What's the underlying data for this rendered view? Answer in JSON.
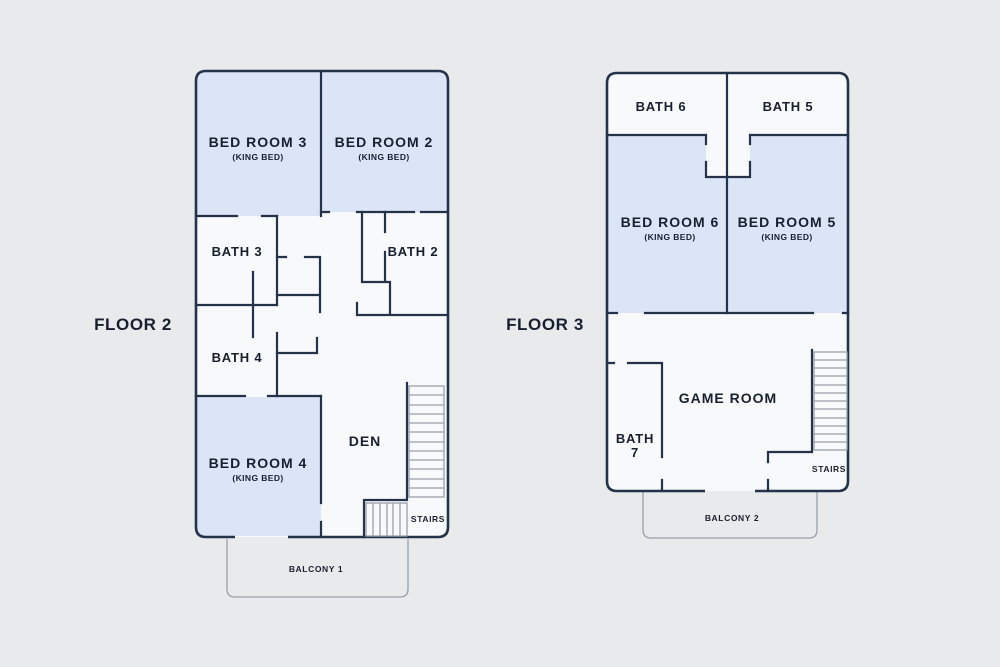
{
  "palette": {
    "background": "#e9eaec",
    "plan_interior": "#f8f9fa",
    "room_fill": "#dbe5f6",
    "wall": "#24324a",
    "stair_balcony_line": "#98a0ab",
    "text": "#18202f"
  },
  "floor2": {
    "label": "FLOOR 2",
    "bedroom3": {
      "name": "BED ROOM 3",
      "sub": "(KING BED)"
    },
    "bedroom2": {
      "name": "BED ROOM 2",
      "sub": "(KING BED)"
    },
    "bedroom4": {
      "name": "BED ROOM 4",
      "sub": "(KING BED)"
    },
    "bath3": {
      "name": "BATH 3"
    },
    "bath2": {
      "name": "BATH 2"
    },
    "bath4": {
      "name": "BATH 4"
    },
    "den": {
      "name": "DEN"
    },
    "stairs": {
      "name": "STAIRS"
    },
    "balcony": {
      "name": "BALCONY 1"
    }
  },
  "floor3": {
    "label": "FLOOR 3",
    "bath6": {
      "name": "BATH 6"
    },
    "bath5": {
      "name": "BATH 5"
    },
    "bedroom6": {
      "name": "BED ROOM 6",
      "sub": "(KING BED)"
    },
    "bedroom5": {
      "name": "BED ROOM 5",
      "sub": "(KING BED)"
    },
    "gameroom": {
      "name": "GAME ROOM"
    },
    "bath7": {
      "lines": [
        "BATH",
        "7"
      ]
    },
    "stairs": {
      "name": "STAIRS"
    },
    "balcony": {
      "name": "BALCONY 2"
    }
  }
}
